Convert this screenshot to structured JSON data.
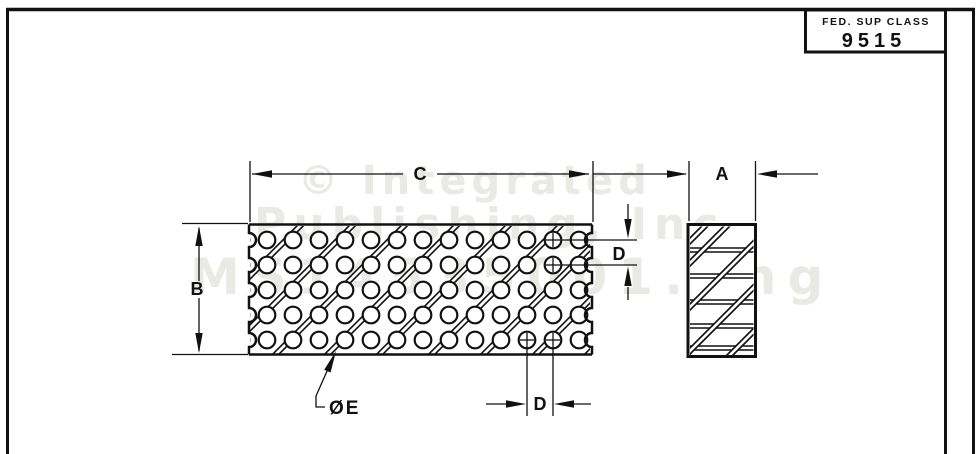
{
  "colors": {
    "ink": "#111111",
    "paper": "#ffffff",
    "watermark": "#e9e9e5"
  },
  "title_block": {
    "label": "FED. SUP CLASS",
    "value": "9515"
  },
  "watermark": {
    "line1": "© Integrated",
    "line2": "Publishing, Inc",
    "line3": "MS14535001.png"
  },
  "labels": {
    "overall_width": "C",
    "thickness": "A",
    "overall_height": "B",
    "hole_pitch_vertical": "D",
    "hole_pitch_horizontal": "D",
    "hole_diameter": "ØE"
  }
}
